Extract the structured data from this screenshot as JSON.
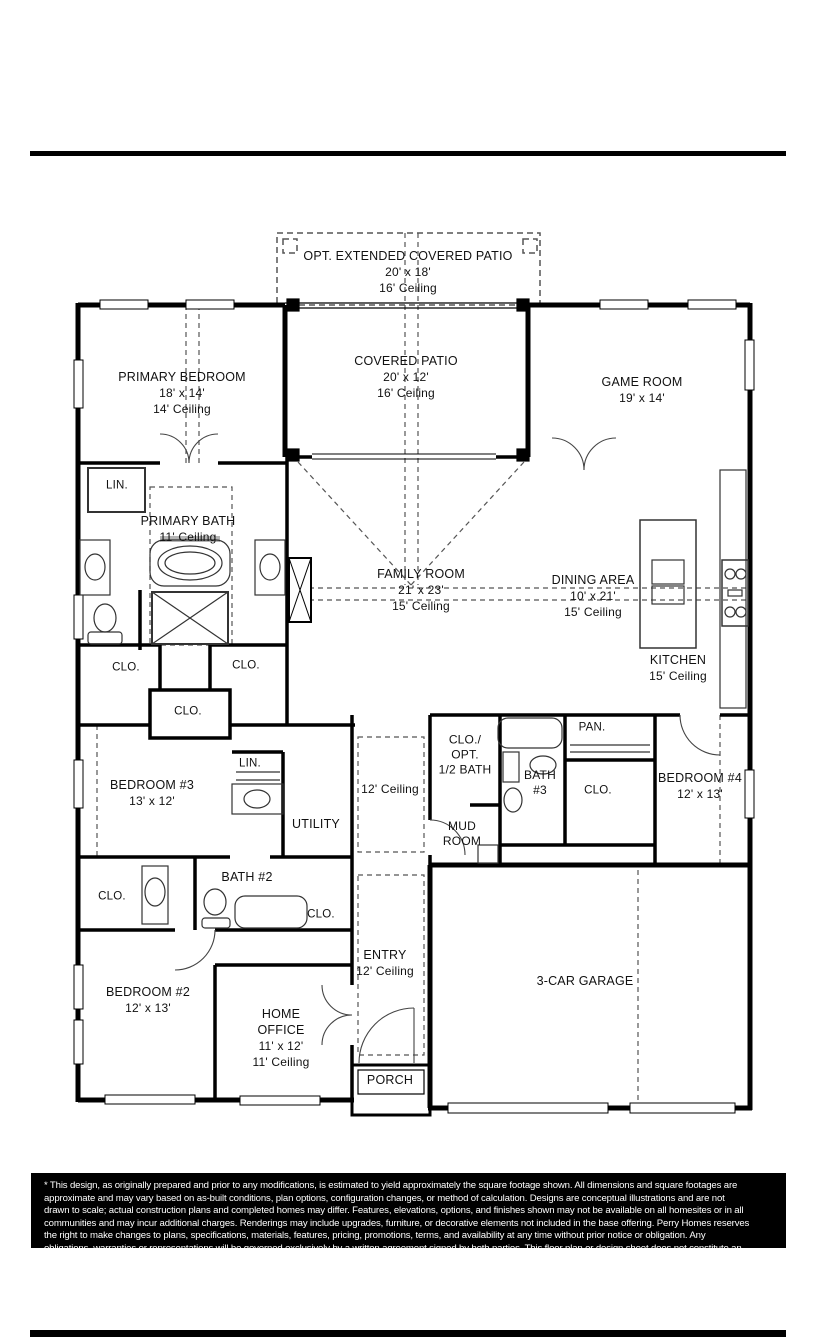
{
  "colors": {
    "wall": "#000000",
    "label_text": "#111111",
    "dash": "#555555",
    "fixture": "#444444",
    "disclaimer_bg": "#000000",
    "disclaimer_text": "#ffffff"
  },
  "plan": {
    "rooms": {
      "opt_patio": {
        "name": "OPT. EXTENDED COVERED PATIO",
        "dims": "20' x 18'",
        "ceiling": "16' Ceiling"
      },
      "primary_bedroom": {
        "name": "PRIMARY BEDROOM",
        "dims": "18' x 14'",
        "ceiling": "14' Ceiling"
      },
      "covered_patio": {
        "name": "COVERED PATIO",
        "dims": "20' x 12'",
        "ceiling": "16' Ceiling"
      },
      "game_room": {
        "name": "GAME ROOM",
        "dims": "19' x 14'"
      },
      "primary_bath": {
        "name": "PRIMARY BATH",
        "ceiling": "11' Ceiling"
      },
      "family_room": {
        "name": "FAMILY ROOM",
        "dims": "21' x 23'",
        "ceiling": "15' Ceiling"
      },
      "dining_area": {
        "name": "DINING AREA",
        "dims": "10' x 21'",
        "ceiling": "15' Ceiling"
      },
      "kitchen": {
        "name": "KITCHEN",
        "ceiling": "15' Ceiling"
      },
      "hall": {
        "ceiling": "12' Ceiling"
      },
      "half_bath": {
        "l1": "CLO./",
        "l2": "OPT.",
        "l3": "1/2 BATH"
      },
      "pantry": {
        "name": "PAN."
      },
      "bath_3": {
        "l1": "BATH",
        "l2": "#3"
      },
      "bedroom_4": {
        "name": "BEDROOM #4",
        "dims": "12' x 13'"
      },
      "bedroom_3": {
        "name": "BEDROOM #3",
        "dims": "13' x 12'"
      },
      "utility": {
        "name": "UTILITY"
      },
      "mud_room": {
        "l1": "MUD",
        "l2": "ROOM"
      },
      "bath_2": {
        "name": "BATH #2"
      },
      "bedroom_2": {
        "name": "BEDROOM #2",
        "dims": "12' x 13'"
      },
      "home_office": {
        "l1": "HOME",
        "l2": "OFFICE",
        "dims": "11' x 12'",
        "ceiling": "11' Ceiling"
      },
      "entry": {
        "name": "ENTRY",
        "ceiling": "12' Ceiling"
      },
      "garage": {
        "name": "3-CAR GARAGE"
      },
      "porch": {
        "name": "PORCH"
      }
    },
    "labels": {
      "closet": "CLO.",
      "linen": "LIN."
    }
  },
  "disclaimer": {
    "lines": [
      "* This design, as originally prepared and prior to any modifications, is estimated to  yield approximately the  square footage  shown.  All dimensions and  square footages are",
      "approximate and  may vary based  on as-built conditions,  plan options,  configuration changes,  or method of  calculation.  Designs are  conceptual  illustrations and  are not",
      "drawn to scale; actual construction plans and completed homes may differ.  Features, elevations,  options,  and finishes shown may not be available on all homesites or in all",
      "communities and may incur additional charges.  Renderings may include upgrades, furniture, or decorative elements not included in the base offering. Perry Homes reserves",
      "the right to make  changes  to plans,  specifications,  materials,  features,  pricing,  promotions,  terms,  and  availability  at any time without  prior  notice  or  obligation.  Any",
      "obligations, warranties or representations will be governed exclusively by a written agreement signed by both parties.  This floor plan or design sheet does not constitute an"
    ]
  }
}
